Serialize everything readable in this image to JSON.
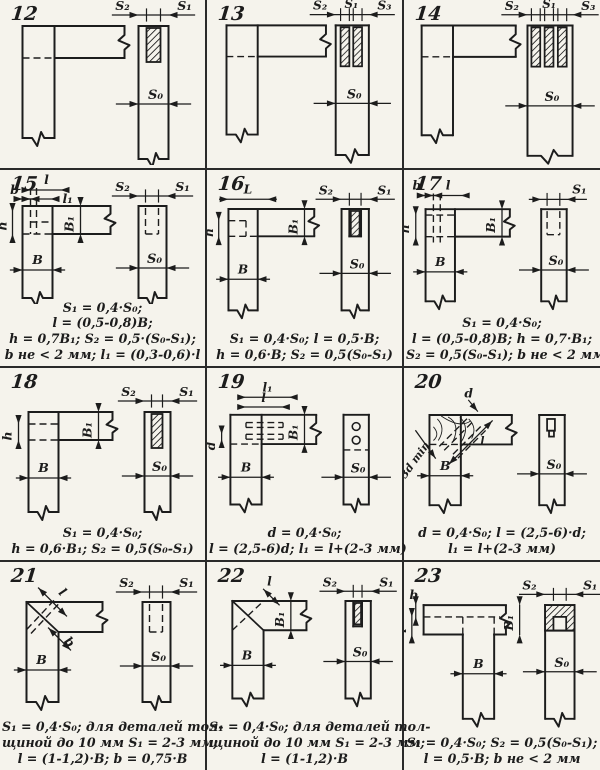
{
  "page": {
    "title": "Угловые соединения — таблица 12–23",
    "colors": {
      "paper": "#f5f3ec",
      "ink": "#1c1c1c"
    }
  },
  "cells": [
    {
      "num": "12",
      "labels": {
        "s2": "S₂",
        "s1": "S₁",
        "s0": "S₀"
      },
      "formulas": []
    },
    {
      "num": "13",
      "labels": {
        "s2": "S₂",
        "s1": "S₁",
        "s3": "S₃",
        "s0": "S₀"
      },
      "formulas": []
    },
    {
      "num": "14",
      "labels": {
        "s2": "S₂",
        "s1": "S₁",
        "s3": "S₃",
        "s0": "S₀"
      },
      "formulas": []
    },
    {
      "num": "15",
      "labels": {
        "b": "b",
        "l": "l",
        "l1": "l₁",
        "h": "h",
        "B1": "B₁",
        "B": "B",
        "s2": "S₂",
        "s1": "S₁",
        "s0": "S₀"
      },
      "formulas": [
        "S₁ = 0,4·S₀;",
        "l = (0,5-0,8)B;",
        "h = 0,7B₁;  S₂ = 0,5·(S₀-S₁);",
        "b не < 2 мм;  l₁ = (0,3-0,6)·l"
      ]
    },
    {
      "num": "16",
      "labels": {
        "L": "L",
        "h": "h",
        "B1": "B₁",
        "B": "B",
        "s2": "S₂",
        "s1": "S₁",
        "s0": "S₀"
      },
      "formulas": [
        "S₁ = 0,4·S₀;   l = 0,5·B;",
        "h = 0,6·B;   S₂ = 0,5(S₀-S₁)"
      ]
    },
    {
      "num": "17",
      "labels": {
        "b": "b",
        "l": "l",
        "h": "h",
        "B1": "B₁",
        "B": "B",
        "s1": "S₁",
        "s0": "S₀"
      },
      "formulas": [
        "S₁ = 0,4·S₀;",
        "l = (0,5-0,8)B;  h = 0,7·B₁;",
        "S₂ = 0,5(S₀-S₁);  b не < 2 мм"
      ]
    },
    {
      "num": "18",
      "labels": {
        "h": "h",
        "B1": "B₁",
        "B": "B",
        "s2": "S₂",
        "s1": "S₁",
        "s0": "S₀"
      },
      "formulas": [
        "S₁ = 0,4·S₀;",
        "h = 0,6·B₁;  S₂ = 0,5(S₀-S₁)"
      ]
    },
    {
      "num": "19",
      "labels": {
        "l1": "l₁",
        "l": "l",
        "d": "d",
        "B1": "B₁",
        "B": "B",
        "s0": "S₀"
      },
      "formulas": [
        "d = 0,4·S₀;",
        "l = (2,5-6)d;  l₁ = l+(2-3 мм)"
      ]
    },
    {
      "num": "20",
      "labels": {
        "d": "d",
        "min": "3d min",
        "l": "l",
        "B": "B",
        "s0": "S₀"
      },
      "formulas": [
        "d = 0,4·S₀;  l = (2,5-6)·d;",
        "l₁ = l+(2-3 мм)"
      ]
    },
    {
      "num": "21",
      "labels": {
        "l": "l",
        "b": "b",
        "B": "B",
        "s2": "S₂",
        "s1": "S₁",
        "s0": "S₀"
      },
      "formulas": [
        "S₁ = 0,4·S₀;  для деталей тол-",
        "щиной до 10 мм  S₁ = 2-3 мм;",
        "l = (1-1,2)·B;   b = 0,75·B"
      ]
    },
    {
      "num": "22",
      "labels": {
        "l": "l",
        "B1": "B₁",
        "B": "B",
        "s2": "S₂",
        "s1": "S₁",
        "s0": "S₀"
      },
      "formulas": [
        "S₁ = 0,4·S₀;  для деталей тол-",
        "щиной до 10 мм  S₁ = 2-3 мм;",
        "l = (1-1,2)·B"
      ]
    },
    {
      "num": "23",
      "labels": {
        "b": "b",
        "l": "l",
        "B1": "B₁",
        "B": "B",
        "s2": "S₂",
        "s1": "S₁",
        "s0": "S₀"
      },
      "formulas": [
        "S₁ = 0,4·S₀;   S₂ = 0,5(S₀-S₁);",
        "l = 0,5·B;    b не < 2 мм"
      ]
    }
  ]
}
